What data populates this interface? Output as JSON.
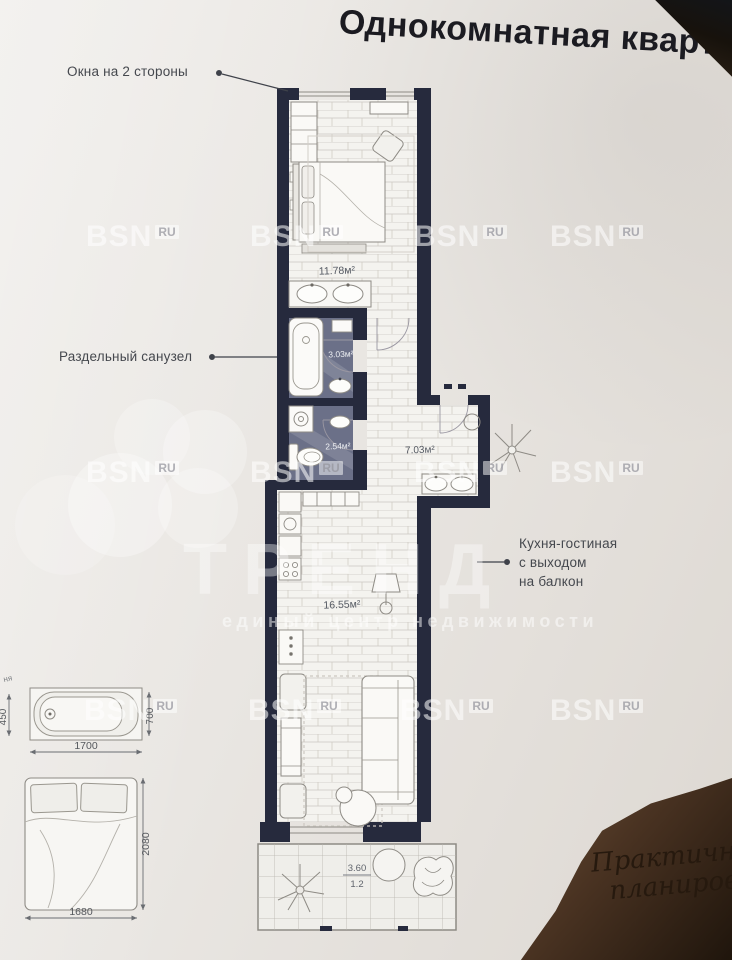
{
  "title": "Однокомнатная квартира",
  "callouts": {
    "windows": "Окна на 2 стороны",
    "bathroom": "Раздельный санузел",
    "kitchen": [
      "Кухня-гостиная",
      "с выходом",
      "на балкон"
    ]
  },
  "areas": {
    "bedroom": "11.78м²",
    "bath": "3.03м²",
    "wc": "2.54м²",
    "hall": "7.03м²",
    "kitchen": "16.55м²",
    "balcony_value": "3.60",
    "balcony_reduced": "1.2"
  },
  "dimensions": {
    "bathtub_length": "1700",
    "bathtub_width": "700",
    "bathtub_height": "450",
    "bed_width": "1680",
    "bed_length": "2080",
    "edge_label": "ня"
  },
  "watermark": {
    "brand": "BSN",
    "tld": "RU",
    "big_text": "ТРЕНД",
    "slogan": "единый центр недвижимости"
  },
  "signature": {
    "line1": "Практичная",
    "line2": "планировка"
  },
  "colors": {
    "wall": "#262a3d",
    "tile_floor": "#6b7088",
    "paper": "#e9e6e2",
    "table_dark": "#2a1d12"
  }
}
